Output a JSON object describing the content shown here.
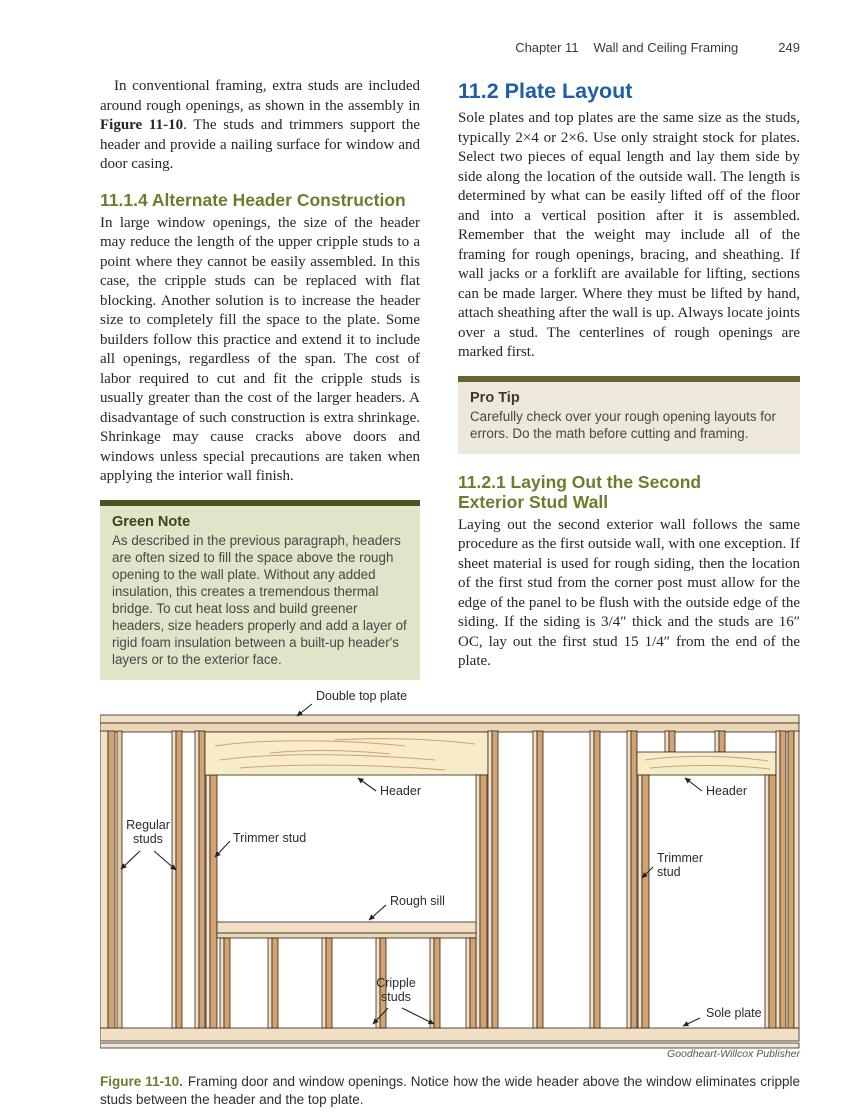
{
  "page_header": {
    "chapter": "Chapter 11",
    "title": "Wall and Ceiling Framing",
    "page_number": "249"
  },
  "left_column": {
    "intro_para": {
      "before_bold": "In conventional framing, extra studs are included around rough openings, as shown in the assembly in ",
      "bold": "Figure 11-10",
      "after_bold": ". The studs and trimmers support the header and provide a nailing surface for window and door casing."
    },
    "section_11_1_4": {
      "heading": "11.1.4 Alternate Header Construction",
      "body": "In large window openings, the size of the header may reduce the length of the upper cripple studs to a point where they cannot be easily assembled. In this case, the cripple studs can be replaced with flat blocking. Another solution is to increase the header size to completely fill the space to the plate. Some builders follow this practice and extend it to include all openings, regardless of the span. The cost of labor required to cut and fit the cripple studs is usually greater than the cost of the larger headers. A disadvantage of such construction is extra shrinkage. Shrinkage may cause cracks above doors and windows unless special precautions are taken when applying the interior wall finish."
    },
    "green_note": {
      "title": "Green Note",
      "body": "As described in the previous paragraph, headers are often sized to fill the space above the rough opening to the wall plate. Without any added insulation, this creates a tremendous thermal bridge. To cut heat loss and build greener headers, size headers properly and add a layer of rigid foam insulation between a built-up header's layers or to the exterior face."
    }
  },
  "right_column": {
    "section_11_2": {
      "heading": "11.2 Plate Layout",
      "body": "Sole plates and top plates are the same size as the studs, typically 2×4 or 2×6. Use only straight stock for plates. Select two pieces of equal length and lay them side by side along the location of the outside wall. The length is determined by what can be easily lifted off of the floor and into a vertical position after it is assembled. Remember that the weight may include all of the framing for rough openings, bracing, and sheathing. If wall jacks or a forklift are available for lifting, sections can be made larger. Where they must be lifted by hand, attach sheathing after the wall is up. Always locate joints over a stud. The centerlines of rough openings are marked first."
    },
    "pro_tip": {
      "title": "Pro Tip",
      "body": "Carefully check over your rough opening layouts for errors. Do the math before cutting and framing."
    },
    "section_11_2_1": {
      "heading": "11.2.1 Laying Out the Second\nExterior Stud Wall",
      "body": "Laying out the second exterior wall follows the same procedure as the first outside wall, with one exception. If sheet material is used for rough siding, then the location of the first stud from the corner post must allow for the edge of the panel to be flush with the outside edge of the siding. If the siding is 3/4″ thick and the studs are 16″ OC, lay out the first stud 15 1/4″ from the end of the plate."
    }
  },
  "figure": {
    "labels": {
      "double_top_plate": "Double top plate",
      "header_window": "Header",
      "regular_studs": "Regular\nstuds",
      "trimmer_stud_window": "Trimmer stud",
      "rough_sill": "Rough sill",
      "cripple_studs": "Cripple\nstuds",
      "header_door": "Header",
      "trimmer_stud_door": "Trimmer\nstud",
      "sole_plate": "Sole plate"
    },
    "credit": "Goodheart-Willcox Publisher",
    "caption_label": "Figure 11-10.",
    "caption_text": "Framing door and window openings. Notice how the wide header above the window eliminates cripple studs between the header and the top plate."
  },
  "footer": {
    "copyright": "Copyright Goodheart-Willcox Co., Inc."
  },
  "colors": {
    "section_heading_olive": "#6e7b2d",
    "main_heading_blue": "#1e5ea6",
    "green_note_bar": "#4c521f",
    "green_note_bg": "#dfe5c8",
    "pro_tip_bar": "#6c6137",
    "pro_tip_bg": "#ede8da",
    "wood_pale": "#f2e0c8",
    "wood_tan": "#d4a271",
    "wood_header": "#f8ebc7"
  }
}
